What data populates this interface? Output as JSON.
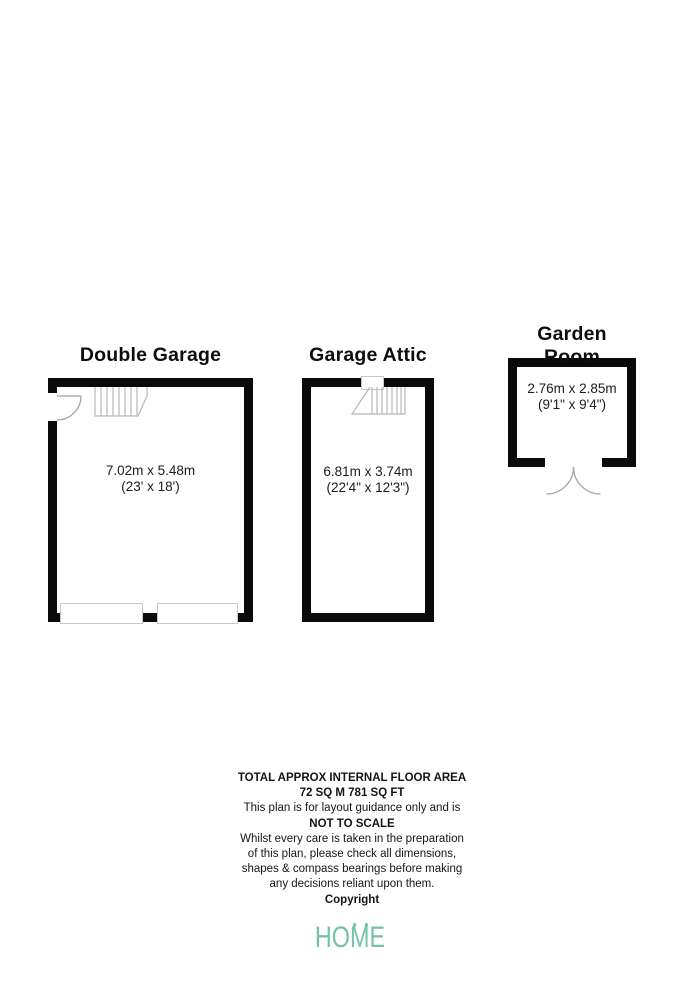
{
  "plan": {
    "rooms": [
      {
        "name": "Double Garage",
        "dim_metric": "7.02m x 5.48m",
        "dim_imperial": "(23' x 18')"
      },
      {
        "name": "Garage Attic",
        "dim_metric": "6.81m x 3.74m",
        "dim_imperial": "(22'4\" x 12'3\")"
      },
      {
        "name": "Garden Room",
        "dim_metric": "2.76m x 2.85m",
        "dim_imperial": "(9'1\" x 9'4\")"
      }
    ]
  },
  "footer": {
    "line1": "TOTAL APPROX INTERNAL FLOOR AREA",
    "line2": "72 SQ M 781 SQ FT",
    "line3": "This plan is for layout guidance only and is",
    "line4": "NOT TO SCALE",
    "line5": "Whilst every care is taken in the preparation",
    "line6": "of this plan, please check all dimensions,",
    "line7": "shapes & compass bearings before making",
    "line8": "any decisions reliant upon them.",
    "line9": "Copyright"
  },
  "logo": {
    "text_ho": "HO",
    "text_m": "M",
    "text_e": "E",
    "color": "#74c2a8"
  },
  "colors": {
    "wall": "#0a0a0a",
    "stair_line": "#b8b8b8",
    "door_line": "#a5a5a5",
    "panel_border": "#c8c8c8"
  }
}
